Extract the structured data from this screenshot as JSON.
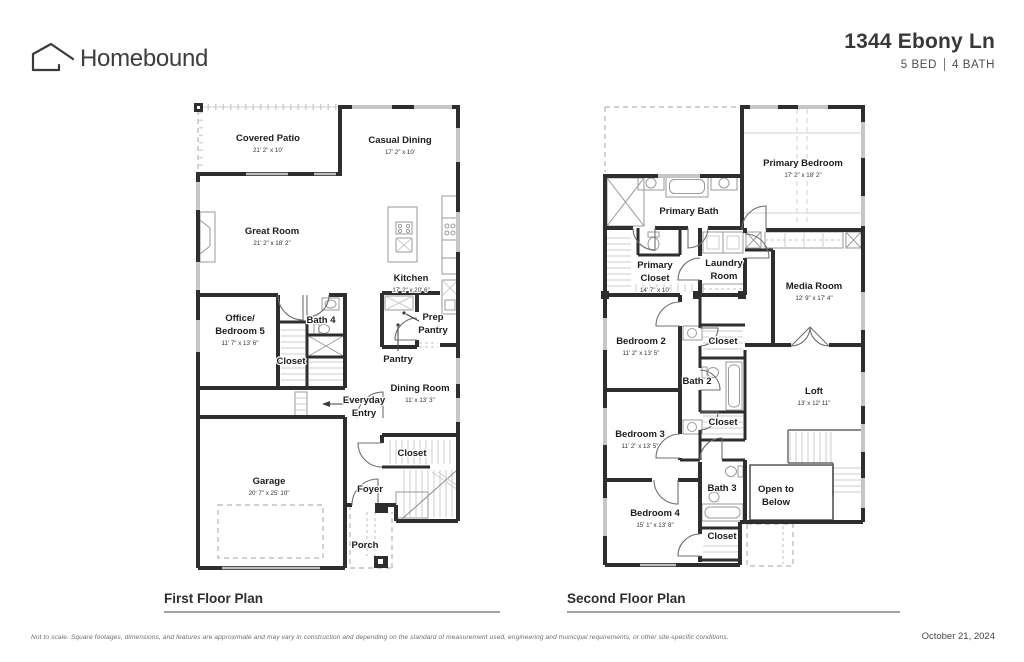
{
  "header": {
    "brand": "Homebound",
    "address": "1344 Ebony Ln",
    "bed": "5 BED",
    "bath": "4 BATH"
  },
  "floor1": {
    "caption": "First Floor Plan",
    "covered_patio": {
      "name": "Covered Patio",
      "dims": "21' 2\" x 10'"
    },
    "casual_dining": {
      "name": "Casual Dining",
      "dims": "17' 2\" x 10'"
    },
    "great_room": {
      "name": "Great Room",
      "dims": "21' 2\" x 18' 2\""
    },
    "kitchen": {
      "name": "Kitchen",
      "dims": "17' 2\" x 20' 6\""
    },
    "prep_pantry": {
      "line1": "Prep",
      "line2": "Pantry"
    },
    "pantry": {
      "name": "Pantry"
    },
    "office": {
      "line1": "Office/",
      "line2": "Bedroom 5",
      "dims": "11' 7\" x 13' 6\""
    },
    "bath4": {
      "name": "Bath 4"
    },
    "closet_office": {
      "name": "Closet"
    },
    "everyday_entry": {
      "line1": "Everyday",
      "line2": "Entry"
    },
    "dining_room": {
      "name": "Dining Room",
      "dims": "11' x 13' 3\""
    },
    "closet_foyer": {
      "name": "Closet"
    },
    "garage": {
      "name": "Garage",
      "dims": "20' 7\" x 25' 10\""
    },
    "foyer": {
      "name": "Foyer"
    },
    "porch": {
      "name": "Porch"
    }
  },
  "floor2": {
    "caption": "Second Floor Plan",
    "primary_bedroom": {
      "name": "Primary Bedroom",
      "dims": "17' 2\" x 18' 2\""
    },
    "primary_bath": {
      "name": "Primary Bath"
    },
    "primary_closet": {
      "line1": "Primary",
      "line2": "Closet",
      "dims": "14' 7\" x 10'"
    },
    "laundry": {
      "line1": "Laundry",
      "line2": "Room"
    },
    "media_room": {
      "name": "Media Room",
      "dims": "12' 9\" x 17' 4\""
    },
    "bedroom2": {
      "name": "Bedroom 2",
      "dims": "11' 2\" x 13' 5\""
    },
    "closet_b2": {
      "name": "Closet"
    },
    "bath2": {
      "name": "Bath 2"
    },
    "closet_b3": {
      "name": "Closet"
    },
    "bedroom3": {
      "name": "Bedroom 3",
      "dims": "11' 2\" x 13' 5\""
    },
    "loft": {
      "name": "Loft",
      "dims": "13' x 12' 11\""
    },
    "bath3": {
      "name": "Bath 3"
    },
    "open_below": {
      "line1": "Open to",
      "line2": "Below"
    },
    "bedroom4": {
      "name": "Bedroom 4",
      "dims": "15' 1\" x 13' 8\""
    },
    "closet_b4": {
      "name": "Closet"
    }
  },
  "footer": {
    "disclaimer": "Not to scale. Square footages, dimensions, and features are approximate and may vary in construction and depending on the standard of measurement used, engineering and municipal requirements, or other site-specific conditions.",
    "date": "October 21, 2024"
  },
  "colors": {
    "wall": "#2e2e2e",
    "light_line": "#b5b5b5",
    "text": "#1c1c1c"
  }
}
